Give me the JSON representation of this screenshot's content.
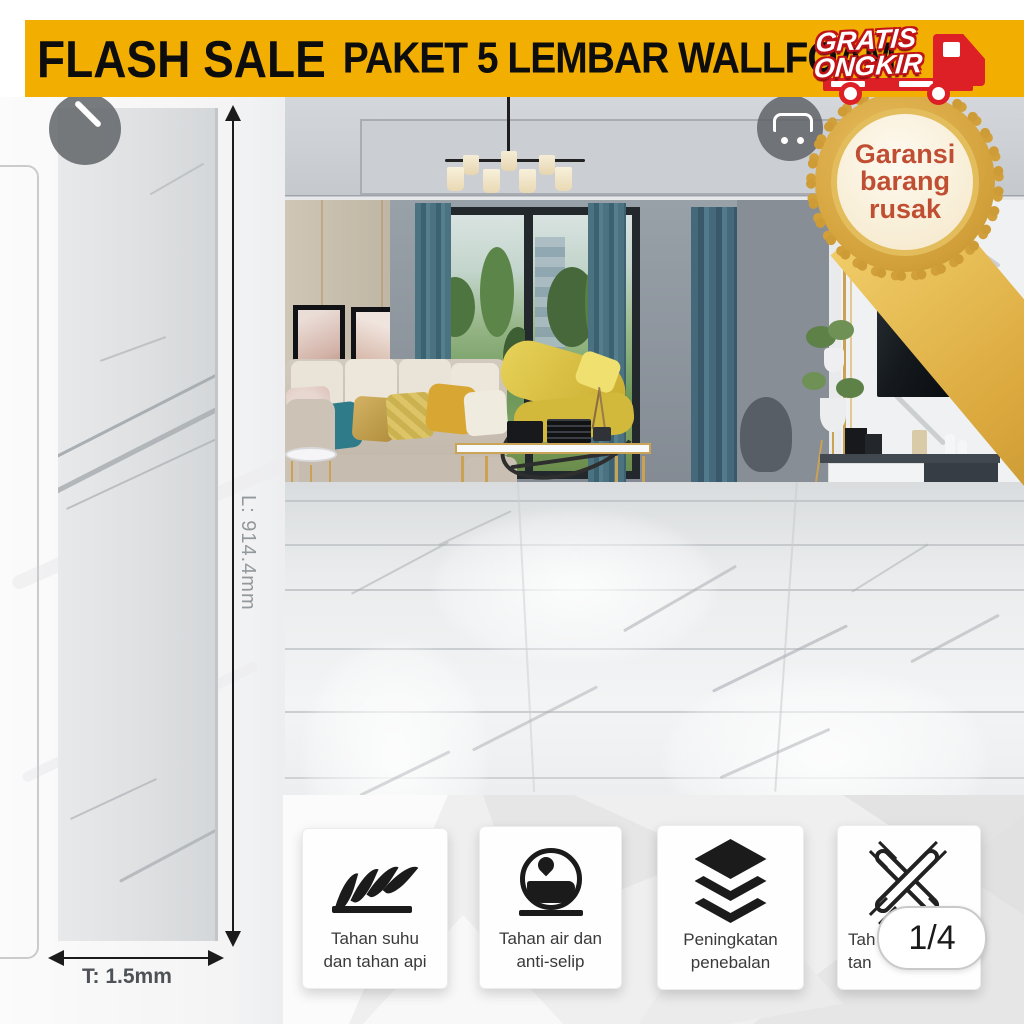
{
  "banner": {
    "title": "FLASH SALE",
    "subtitle": "PAKET 5 LEMBAR WALLFOAM",
    "bg_color": "#F2AE01",
    "text_color": "#0D0D0D"
  },
  "free_shipping_badge": {
    "line1": "GRATIS",
    "line2": "ONGKIR",
    "red": "#DD1F26"
  },
  "warranty_badge": {
    "line1": "Garansi",
    "line2": "barang",
    "line3": "rusak",
    "gold": "#D2A03A",
    "text_color": "#BF4E33"
  },
  "sample": {
    "length_label": "L: 914.4mm",
    "thickness_label": "T: 1.5mm"
  },
  "features": [
    {
      "icon": "fire-icon",
      "line1": "Tahan suhu",
      "line2": "dan tahan api"
    },
    {
      "icon": "water-drop-icon",
      "line1": "Tahan air dan",
      "line2": "anti-selip"
    },
    {
      "icon": "layers-icon",
      "line1": "Peningkatan",
      "line2": "penebalan"
    },
    {
      "icon": "weave-icon",
      "line1": "Tah",
      "line2": "tan"
    }
  ],
  "pager": "1/4"
}
